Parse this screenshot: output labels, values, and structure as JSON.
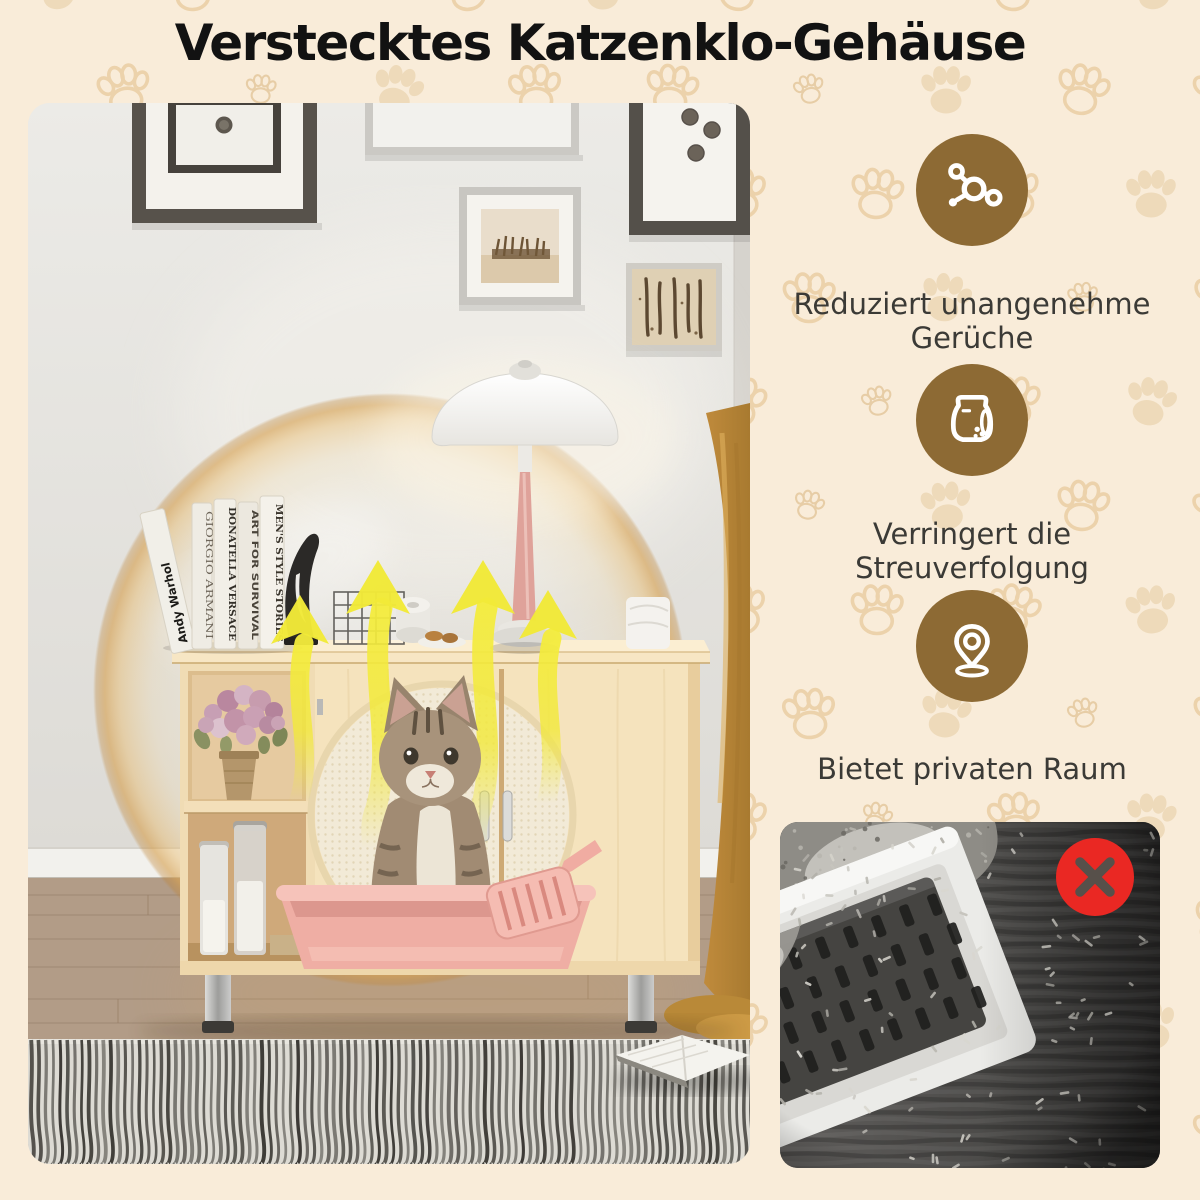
{
  "background": {
    "color": "#f9ecd9",
    "paw_tint": "#eedaba"
  },
  "title": {
    "text": "Verstecktes Katzenklo-Gehäuse",
    "color": "#121212"
  },
  "features": [
    {
      "icon": "odor-molecule-icon",
      "circle_color": "#8d6a34",
      "lines": [
        "Reduziert unangenehme",
        "Gerüche"
      ]
    },
    {
      "icon": "litter-bag-icon",
      "circle_color": "#8d6a34",
      "lines": [
        "Verringert die",
        "Streuverfolgung"
      ]
    },
    {
      "icon": "location-pin-icon",
      "circle_color": "#8d6a34",
      "lines": [
        "Bietet privaten Raum"
      ]
    }
  ],
  "scene": {
    "books": [
      "Andy Warhol",
      "GIORGIO ARMANI",
      "DONATELLA VERSACE",
      "ART FOR SURVIVAL",
      "MEN'S STYLE STORIES"
    ],
    "arrow_color": "#f2ea38",
    "wood_color": "#f0dcb4",
    "litter_box_color": "#efaea4"
  },
  "comparison": {
    "badge_icon": "x-mark-icon",
    "badge_color": "#ea2823"
  }
}
